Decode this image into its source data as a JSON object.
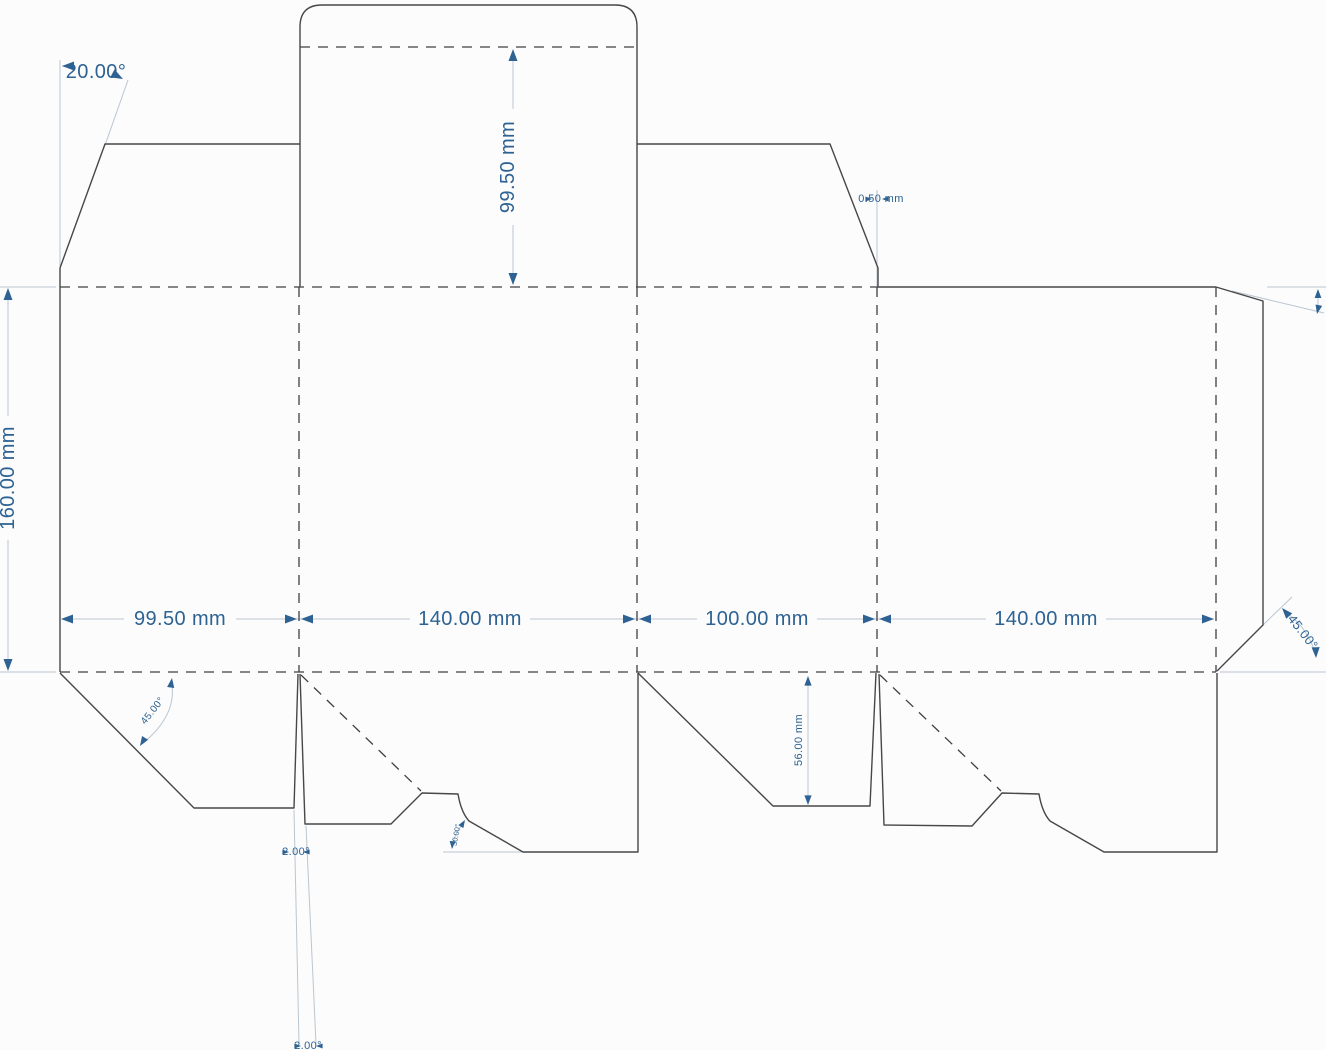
{
  "dieline": {
    "colors": {
      "background": "#fcfcfd",
      "cut_line": "#474747",
      "fold_line": "#3f3f3f",
      "dimension_line": "#bac6d0",
      "dimension_accent": "#2d6292"
    },
    "top": {
      "angle_left": "20.00°",
      "lid_depth": "99.50 mm",
      "notch_gap": "0.50 mm"
    },
    "side": {
      "height": "160.00 mm"
    },
    "panels": [
      {
        "width": "99.50 mm"
      },
      {
        "width": "140.00 mm"
      },
      {
        "width": "100.00 mm"
      },
      {
        "width": "140.00 mm"
      }
    ],
    "bottom": {
      "dust_flap_angle": "45.00°",
      "curve_angle": "30.00°",
      "inner_flap_depth": "56.00 mm",
      "lock_slit_angle_1": "2.00°",
      "lock_slit_angle_2": "2.00°",
      "glue_flap_angle": "45.00°"
    }
  }
}
